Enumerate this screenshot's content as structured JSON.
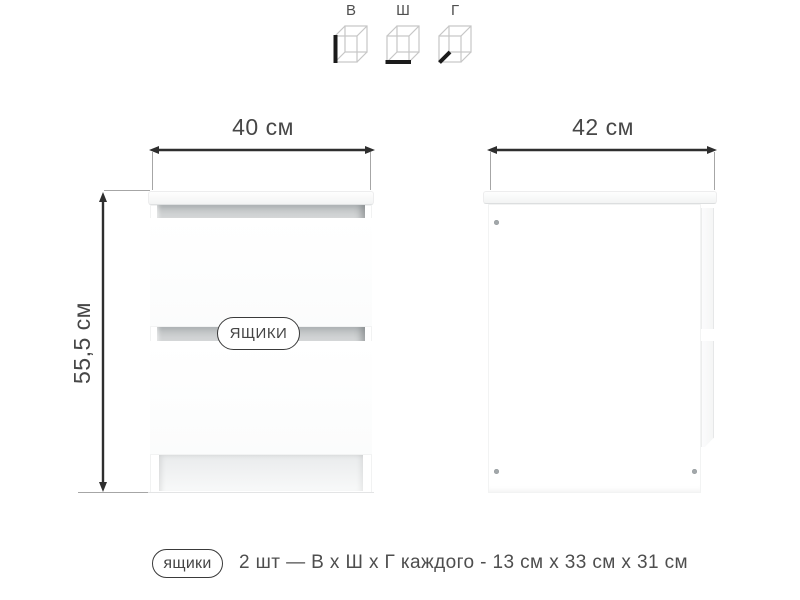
{
  "legend": {
    "items": [
      {
        "label": "В",
        "icon": "cube-height-icon",
        "meaning": "высота"
      },
      {
        "label": "Ш",
        "icon": "cube-width-icon",
        "meaning": "ширина"
      },
      {
        "label": "Г",
        "icon": "cube-depth-icon",
        "meaning": "глубина"
      }
    ]
  },
  "front_view": {
    "width_label": "40 см",
    "height_label": "55,5 см",
    "drawers_badge": "ЯЩИКИ"
  },
  "side_view": {
    "depth_label": "42 см"
  },
  "footer": {
    "badge_label": "ящики",
    "text": "2 шт — В х Ш х Г каждого - 13 см х 33 см х 31 см"
  },
  "colors": {
    "dimension_line": "#2e2e2e",
    "extension_line": "#a6a6a6",
    "text": "#4a4a4a",
    "cube_outline": "#c6c6c6",
    "cube_accent": "#1b1b1b",
    "recess_shadow": "#aeb3b5",
    "background": "#ffffff"
  }
}
